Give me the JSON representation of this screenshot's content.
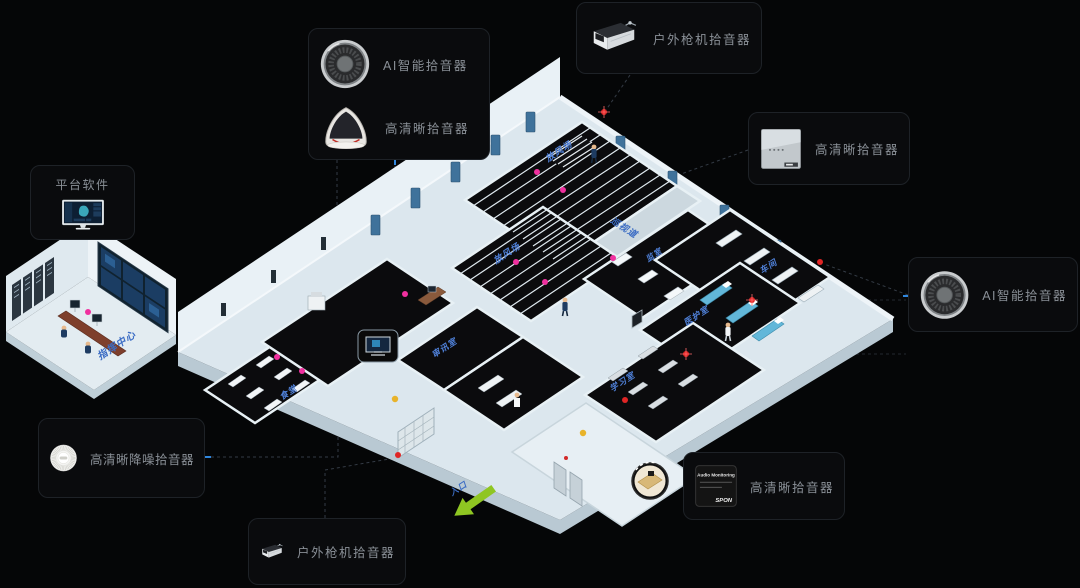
{
  "palette": {
    "bg": "#050607",
    "box_bg": "#0a0b0d",
    "box_border": "#1e2227",
    "label_gray": "#8a9097",
    "room_label_blue": "#3b6cc4",
    "dot_pink": "#f0309f",
    "dot_red": "#e02525",
    "dot_amber": "#e8b32a",
    "arrow_green": "#8fc622",
    "wall_light": "#e8f1f6",
    "floor_dark": "#0b0b0d"
  },
  "callouts": {
    "ai_hd_top": {
      "label1": "AI智能拾音器",
      "label2": "高清晰拾音器"
    },
    "outdoor_top": {
      "label": "户外枪机拾音器"
    },
    "hd_right": {
      "label": "高清晰拾音器"
    },
    "ai_right": {
      "label": "AI智能拾音器"
    },
    "platform_left": {
      "title": "平台软件"
    },
    "noise_bottom_left": {
      "label": "高清晰降噪拾音器"
    },
    "outdoor_bottom": {
      "label": "户外枪机拾音器"
    },
    "hd_bottom_right": {
      "label": "高清晰拾音器",
      "device_text": "Audio Monitoring",
      "device_brand": "SPON"
    }
  },
  "floorplan": {
    "rooms": [
      {
        "name": "放风场"
      },
      {
        "name": "放风场"
      },
      {
        "name": "巡视道"
      },
      {
        "name": "监室"
      },
      {
        "name": "车间"
      },
      {
        "name": "医护室"
      },
      {
        "name": "学习室"
      },
      {
        "name": "审讯室"
      },
      {
        "name": "食堂"
      },
      {
        "name": "指挥中心"
      },
      {
        "name": "入口"
      }
    ]
  }
}
